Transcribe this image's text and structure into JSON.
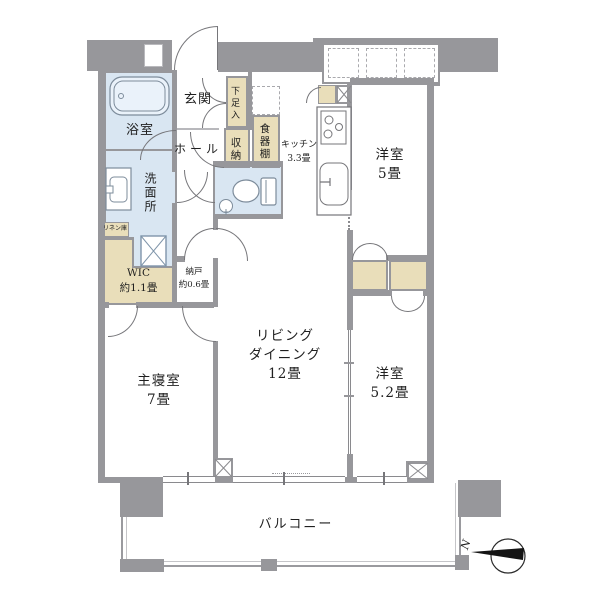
{
  "colors": {
    "wall": "#97979b",
    "wet_room": "#d9e6f2",
    "storage_tan": "#e9deba"
  },
  "rooms": {
    "genkan": {
      "label": "玄関"
    },
    "hall": {
      "label": "ホール"
    },
    "shoe_cabinet": {
      "label": "下足入"
    },
    "storage": {
      "label": "収納"
    },
    "cupboard": {
      "label": "食器棚"
    },
    "kitchen": {
      "lines": [
        "キッチン",
        "3.3畳"
      ]
    },
    "bathroom": {
      "label": "浴室"
    },
    "washroom": {
      "label": "洗面所"
    },
    "linen": {
      "label": "リネン庫"
    },
    "wic": {
      "lines": [
        "WIC",
        "約1.1畳"
      ]
    },
    "nando": {
      "lines": [
        "納戸",
        "約0.6畳"
      ]
    },
    "bedroom": {
      "lines": [
        "主寝室",
        "7畳"
      ]
    },
    "living_dining": {
      "lines": [
        "リビング",
        "ダイニング",
        "12畳"
      ]
    },
    "western5": {
      "lines": [
        "洋室",
        "5畳"
      ]
    },
    "western52": {
      "lines": [
        "洋室",
        "5.2畳"
      ]
    },
    "balcony": {
      "label": "バルコニー"
    }
  },
  "compass": {
    "north_label": "N"
  }
}
